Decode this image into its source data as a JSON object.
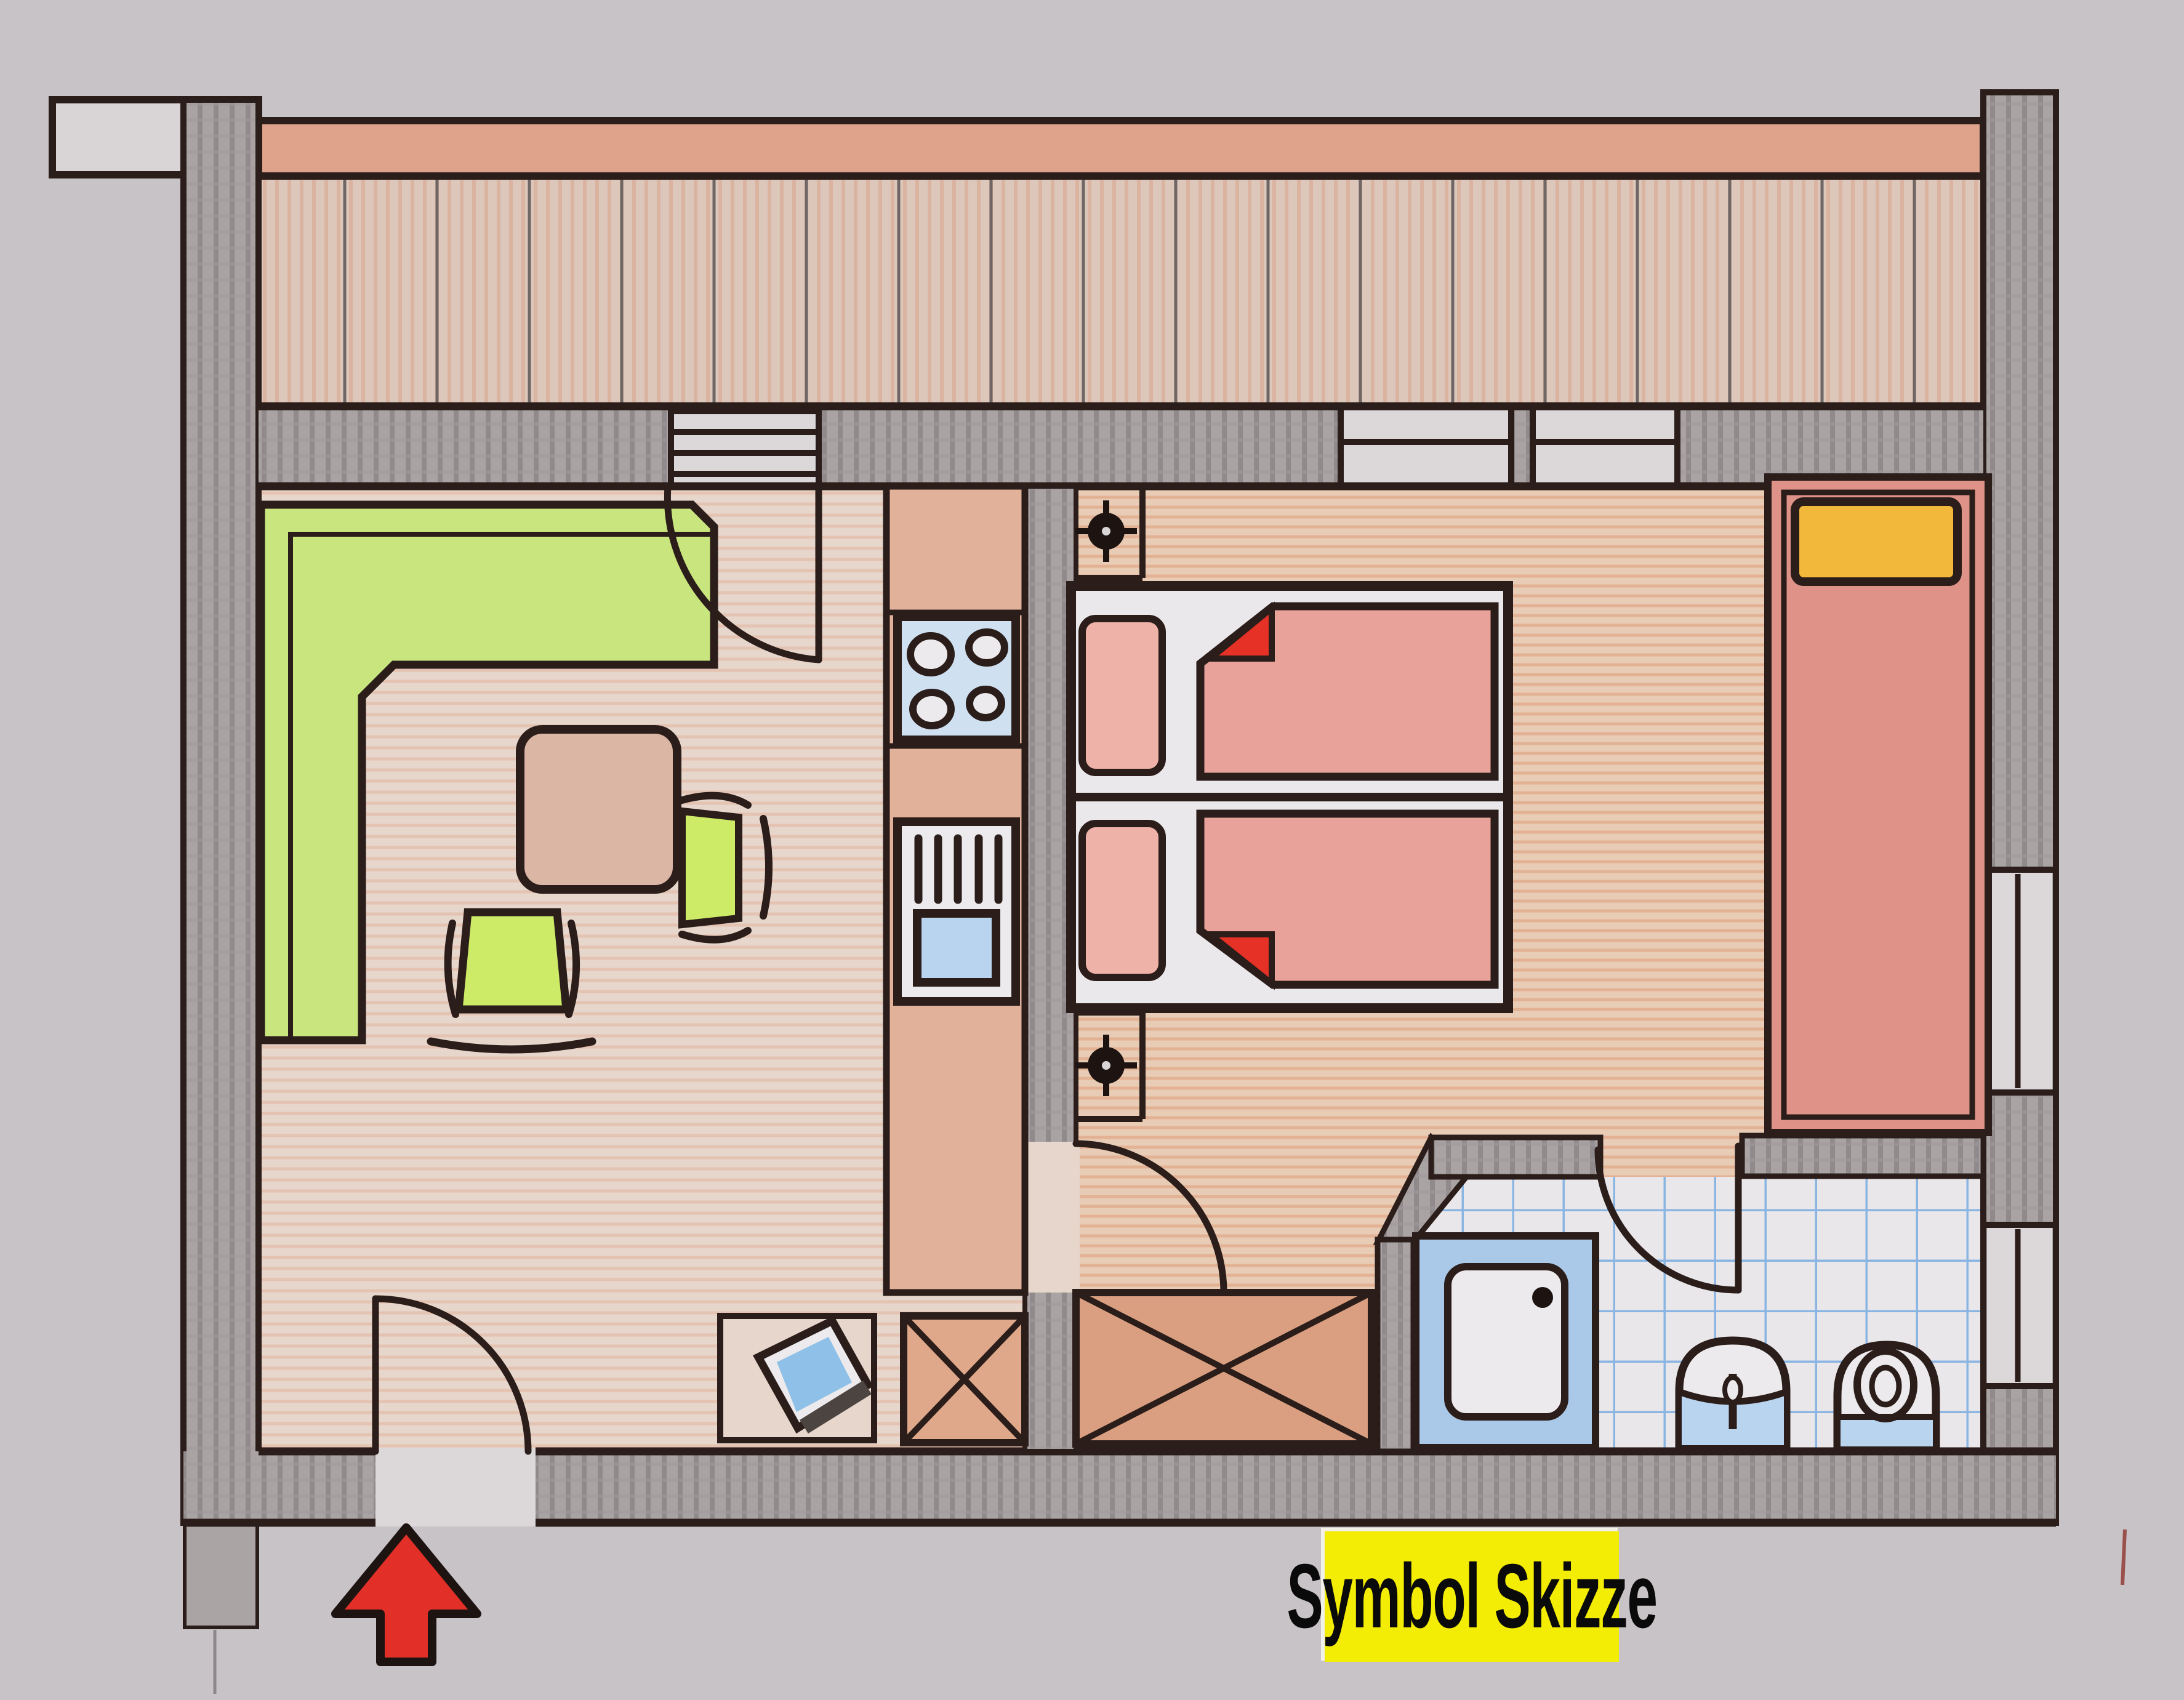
{
  "label": {
    "text": "Symbol Skizze"
  },
  "palette": {
    "paper": "#c7c3c7",
    "wall_pencil_gray": "#a9a3a4",
    "ink_outline": "#2b1d1a",
    "railing_red": "#dfa28b",
    "balcony_deck": "#ddc7ba",
    "living_floor": "#e7d6cb",
    "bedroom_floor": "#e8ccb5",
    "kitchen_counter": "#e1b199",
    "bench_green": "#c9e57d",
    "chair_green": "#cdeb66",
    "table_pink": "#dbb6a5",
    "bed_pink": "#e8a29a",
    "pillow_pink": "#efb2a8",
    "fold_red": "#e63226",
    "single_bed_red": "#df9287",
    "pillow_yellow": "#f2b83c",
    "appliance_blue": "#cfe0f1",
    "basin_blue": "#b9d4ee",
    "tile_line_blue": "#8ab5e2",
    "tv_screen_blue": "#8fc0e8",
    "arrow_red": "#e23028",
    "label_yellow": "#f3ec04",
    "label_text": "#0a0a0a"
  },
  "rooms": [
    {
      "name": "balcony"
    },
    {
      "name": "living-dining-room"
    },
    {
      "name": "kitchen"
    },
    {
      "name": "bedroom"
    },
    {
      "name": "bathroom"
    }
  ],
  "symbols": [
    {
      "name": "entrance-arrow",
      "meaning": "entrance direction"
    },
    {
      "name": "corner-bench"
    },
    {
      "name": "dining-table"
    },
    {
      "name": "chairs"
    },
    {
      "name": "cooktop-4-burners"
    },
    {
      "name": "sink-unit"
    },
    {
      "name": "double-bed-with-duvets"
    },
    {
      "name": "single-bed-yellow-pillow"
    },
    {
      "name": "ceiling-light-crosshair",
      "count": 2
    },
    {
      "name": "tv-set"
    },
    {
      "name": "wardrobe-x-box",
      "count": 2
    },
    {
      "name": "shower-tray"
    },
    {
      "name": "washbasin"
    },
    {
      "name": "toilet"
    },
    {
      "name": "door-swings",
      "count": 4
    },
    {
      "name": "windows"
    }
  ]
}
